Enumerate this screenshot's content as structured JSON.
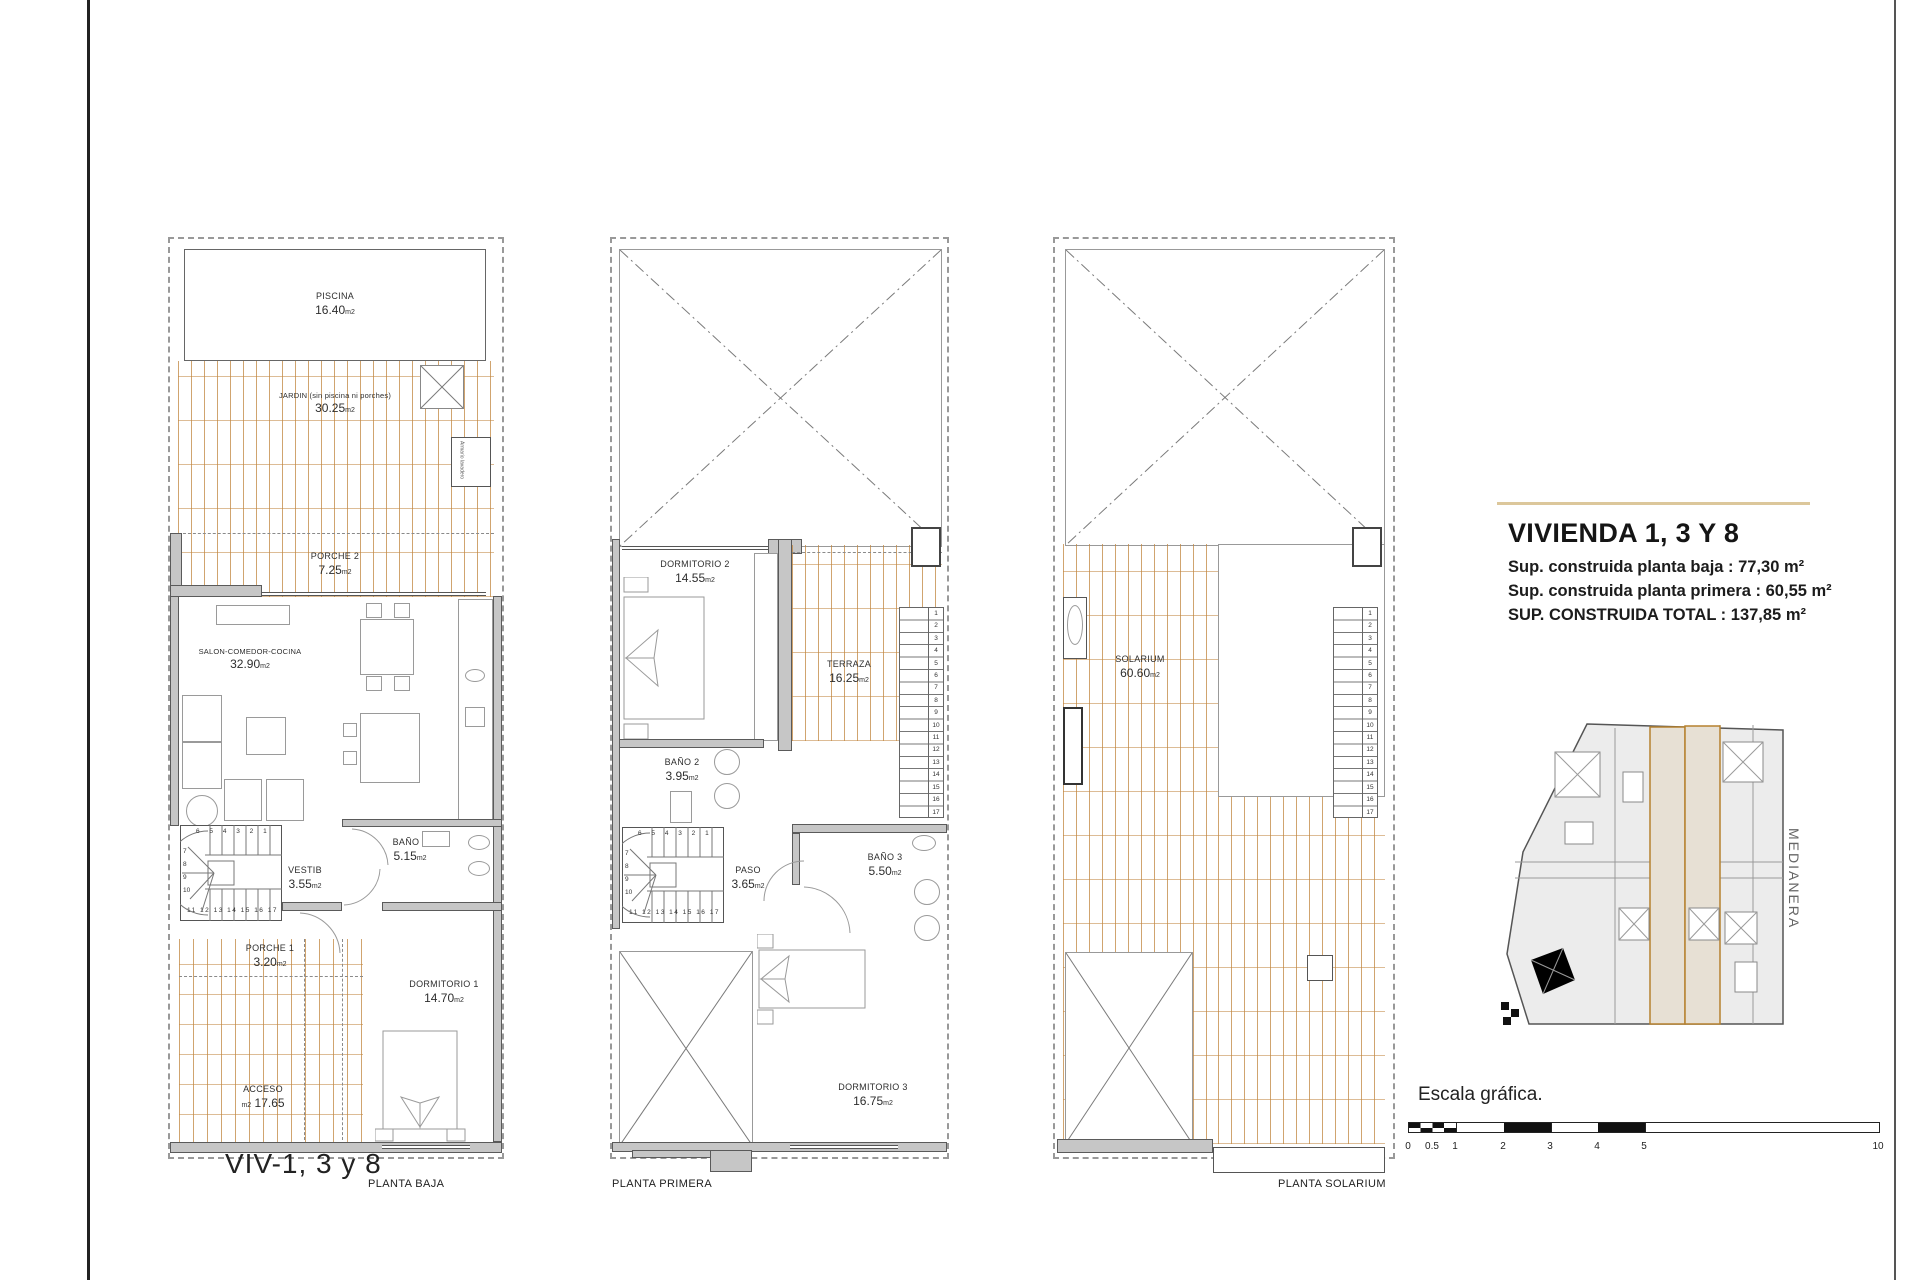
{
  "page": {
    "big_label": "VIV-1, 3 y 8"
  },
  "plans": [
    {
      "footer": "PLANTA BAJA",
      "rooms": [
        {
          "name": "PISCINA",
          "area": "16.40",
          "unit": "m2"
        },
        {
          "name": "JARDIN (sin piscina ni porches)",
          "area": "30.25",
          "unit": "m2"
        },
        {
          "name": "PORCHE 2",
          "area": "7.25",
          "unit": "m2"
        },
        {
          "name": "SALON-COMEDOR-COCINA",
          "area": "32.90",
          "unit": "m2"
        },
        {
          "name": "VESTIB",
          "area": "3.55",
          "unit": "m2"
        },
        {
          "name": "BAÑO 1",
          "area": "5.15",
          "unit": "m2"
        },
        {
          "name": "PORCHE 1",
          "area": "3.20",
          "unit": "m2"
        },
        {
          "name": "ACCESO",
          "area": "17.65",
          "unit": "m2"
        },
        {
          "name": "DORMITORIO 1",
          "area": "14.70",
          "unit": "m2"
        }
      ],
      "closet_label": "Armario lavadero"
    },
    {
      "footer": "PLANTA PRIMERA",
      "rooms": [
        {
          "name": "DORMITORIO 2",
          "area": "14.55",
          "unit": "m2"
        },
        {
          "name": "TERRAZA",
          "area": "16.25",
          "unit": "m2"
        },
        {
          "name": "BAÑO 2",
          "area": "3.95",
          "unit": "m2"
        },
        {
          "name": "PASO",
          "area": "3.65",
          "unit": "m2"
        },
        {
          "name": "BAÑO 3",
          "area": "5.50",
          "unit": "m2"
        },
        {
          "name": "DORMITORIO 3",
          "area": "16.75",
          "unit": "m2"
        }
      ]
    },
    {
      "footer": "PLANTA SOLARIUM",
      "rooms": [
        {
          "name": "SOLARIUM",
          "area": "60.60",
          "unit": "m2"
        }
      ]
    }
  ],
  "stair": {
    "top_row": "6 5 4 3 2 1",
    "left_col": "7\n8\n9\n10",
    "bottom_row": "11 12 13 14 15 16 17",
    "run_numbers": "1\n2\n3\n4\n5\n6\n7\n8\n9\n10\n11\n12\n13\n14\n15\n16\n17"
  },
  "title_block": {
    "title": "VIVIENDA 1, 3 Y 8",
    "lines": [
      "Sup. construida planta baja : 77,30 m²",
      "Sup. construida planta primera : 60,55 m²",
      "SUP. CONSTRUIDA TOTAL : 137,85 m²"
    ]
  },
  "key_plan": {
    "medianera": "MEDIANERA"
  },
  "scale": {
    "label": "Escala gráfica.",
    "ticks": [
      "0",
      "0.5",
      "1",
      "2",
      "3",
      "4",
      "5",
      "10"
    ]
  },
  "colors": {
    "hatch_line": "#c1863f",
    "wall_fill": "#c6c6c6",
    "accent_rule": "#dcc79b"
  }
}
